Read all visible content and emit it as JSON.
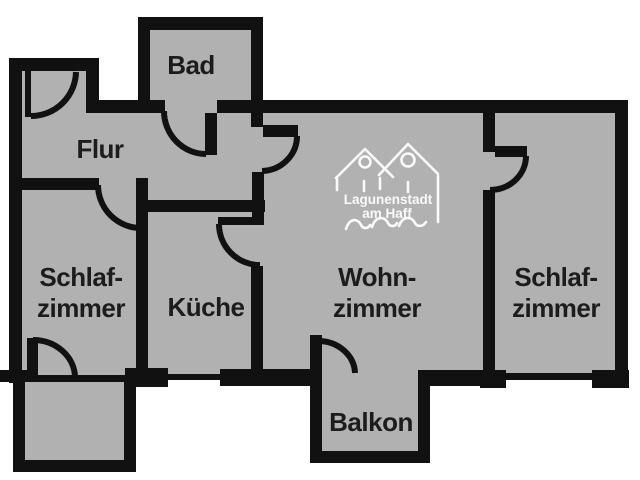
{
  "colors": {
    "background": "#ffffff",
    "room_fill": "#b1b1b1",
    "wall": "#111111",
    "label_text": "#1c1c1c",
    "logo": "#fafafa"
  },
  "rooms": {
    "bad": {
      "label": "Bad"
    },
    "flur": {
      "label": "Flur"
    },
    "schlafzimmer_links": {
      "line1": "Schlaf-",
      "line2": "zimmer"
    },
    "kueche": {
      "label": "Küche"
    },
    "wohnzimmer": {
      "line1": "Wohn-",
      "line2": "zimmer"
    },
    "schlafzimmer_rechts": {
      "line1": "Schlaf-",
      "line2": "zimmer"
    },
    "balkon": {
      "label": "Balkon"
    }
  },
  "logo": {
    "line1": "Lagunenstadt",
    "line2": "am Haff"
  }
}
